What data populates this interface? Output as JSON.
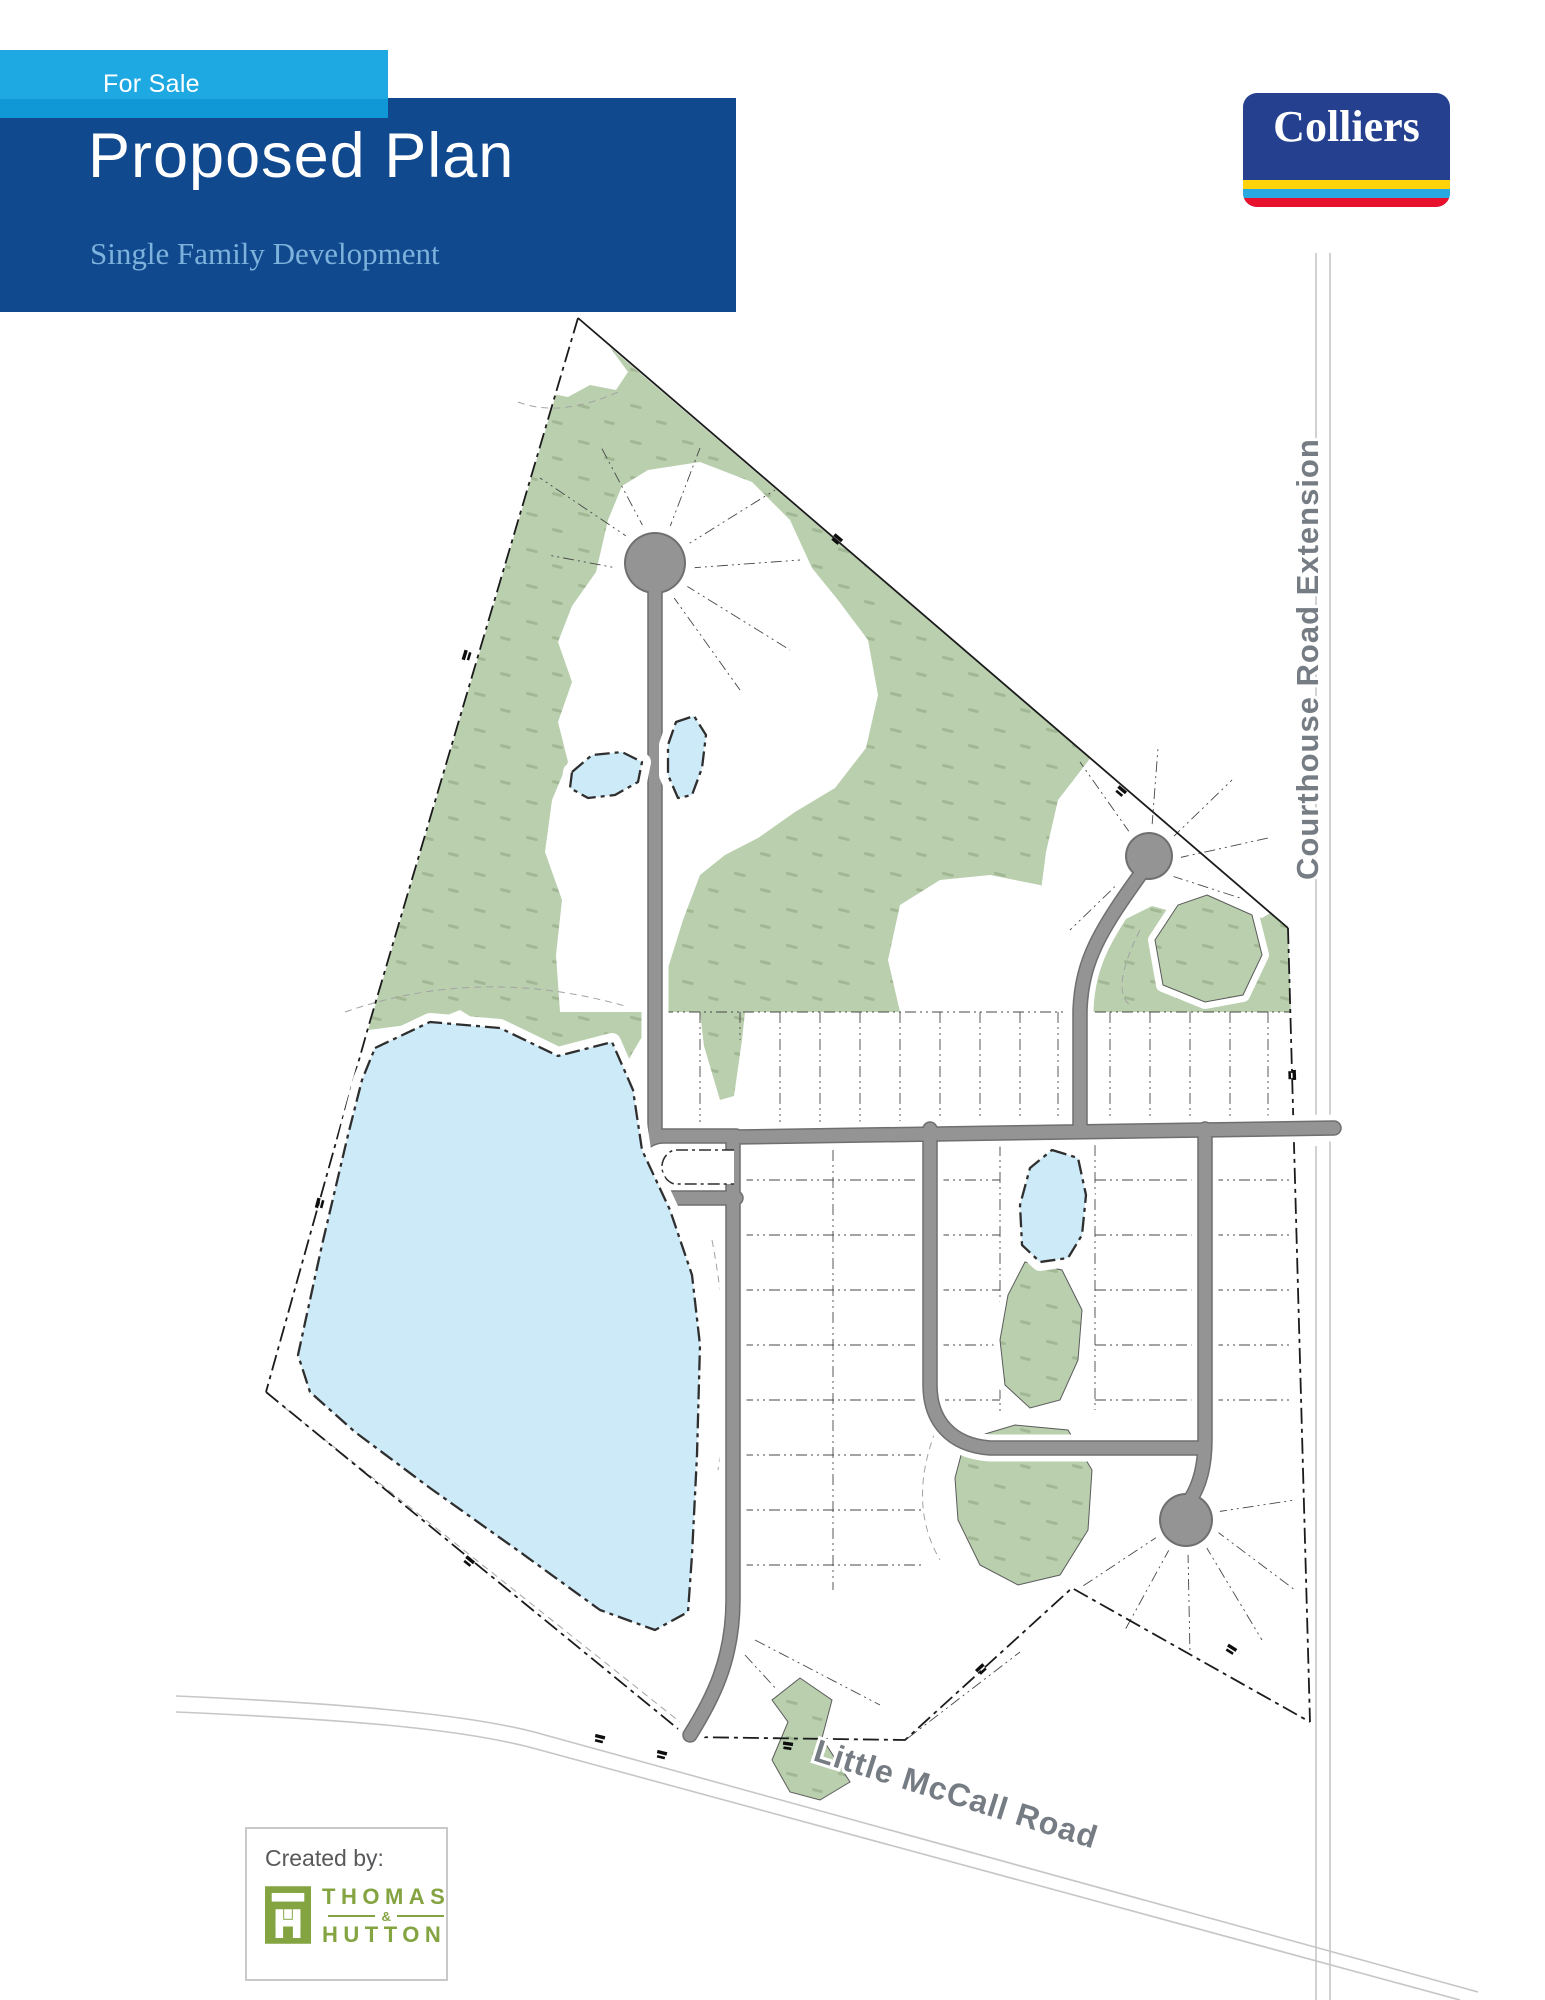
{
  "header": {
    "for_sale_label": "For Sale",
    "title": "Proposed Plan",
    "subtitle": "Single Family Development"
  },
  "branding": {
    "colliers_wordmark": "Colliers"
  },
  "map": {
    "labels": {
      "courthouse_road": "Courthouse Road Extension",
      "little_mccall_road": "Little McCall Road"
    },
    "features": {
      "open_space": "wooded open space",
      "ponds": "stormwater ponds",
      "roads": "proposed internal roads with cul-de-sacs",
      "lots": "single family lots"
    }
  },
  "footer": {
    "created_by_label": "Created by:",
    "firm_line1": "THOMAS",
    "firm_amp": "&",
    "firm_line2": "HUTTON"
  },
  "colors": {
    "banner_blue": "#1ea9e2",
    "header_blue": "#11498f",
    "subtitle_blue": "#7cb2db",
    "colliers_blue": "#24408f",
    "stripe_yellow": "#ffd20a",
    "stripe_light_blue": "#28a9e0",
    "stripe_red": "#e8112d",
    "forest_green": "#b9cfae",
    "pond_blue": "#cdeaf8",
    "road_gray": "#949494",
    "road_label_gray": "#767c83",
    "thomas_hutton_green": "#84a341"
  }
}
